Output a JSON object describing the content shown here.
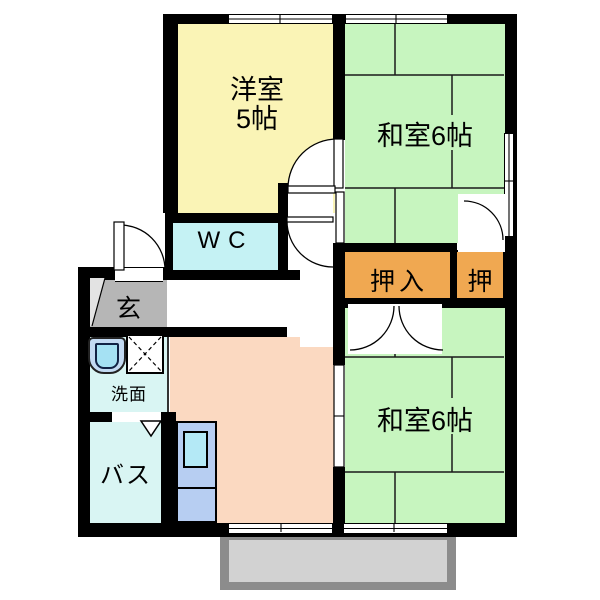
{
  "plan_title": "2DK apartment floor plan",
  "rooms": {
    "western": {
      "l1": "洋室",
      "l2": "5帖",
      "color": "#faf4b6"
    },
    "jp_upper": {
      "label": "和室6帖",
      "color": "#c7f5bf"
    },
    "jp_lower": {
      "label": "和室6帖",
      "color": "#c7f5bf"
    },
    "wc": {
      "label": "WC",
      "color": "#c5f2f4"
    },
    "entrance": {
      "label": "玄",
      "color": "#b6b6b6"
    },
    "washroom": {
      "label": "洗面",
      "color": "#d9f5f3"
    },
    "bath": {
      "label": "バス",
      "color": "#d9f5f3"
    },
    "closet_large": {
      "label": "押入",
      "color": "#f0a851"
    },
    "closet_small": {
      "label": "押",
      "color": "#f0a851"
    },
    "dining_kitchen": {
      "color": "#fbd9c1"
    },
    "balcony": {
      "frame_color": "#8c8c8c",
      "floor_color": "#d2d2d2"
    }
  },
  "fixture_icons": [
    "kitchen-unit-icon",
    "kitchen-sink-icon",
    "washbasin-icon",
    "washing-machine-pan-icon",
    "folding-door-icon",
    "door-swing-icon",
    "sliding-door-icon",
    "window-icon"
  ],
  "wall_color": "#000000"
}
